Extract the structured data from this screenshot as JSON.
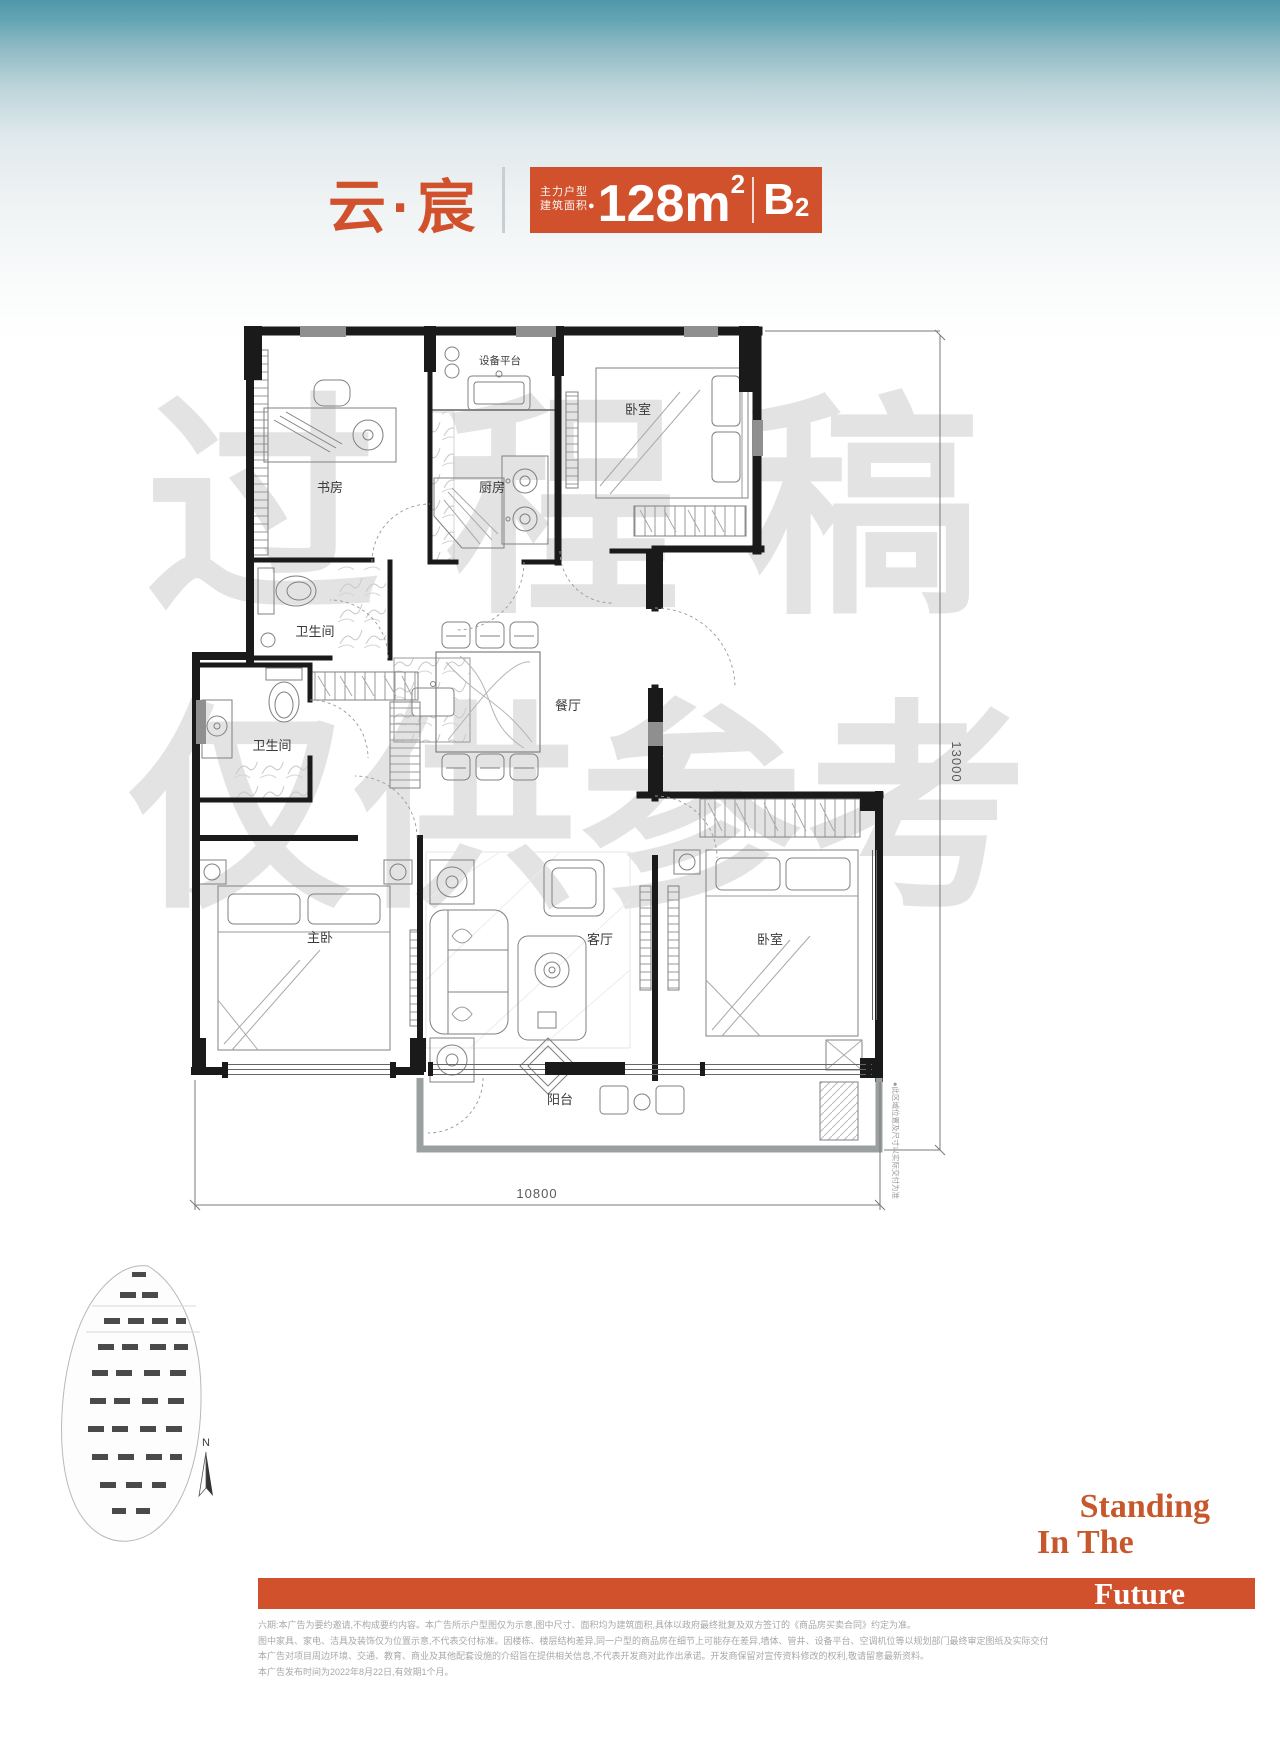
{
  "accent_color": "#d0512c",
  "header": {
    "title": "云·宸",
    "badge": {
      "type_line1": "主力户型",
      "type_line2": "建筑面积●",
      "area": "128m",
      "area_sup": "2",
      "unit": "B",
      "unit_sub": "2"
    }
  },
  "watermark": {
    "line1": "过程稿",
    "line2": "仅供参考"
  },
  "floor_plan": {
    "rooms": [
      {
        "label": "设备平台"
      },
      {
        "label": "书房"
      },
      {
        "label": "厨房"
      },
      {
        "label": "卧室"
      },
      {
        "label": "卫生间"
      },
      {
        "label": "卫生间"
      },
      {
        "label": "餐厅"
      },
      {
        "label": "主卧"
      },
      {
        "label": "客厅"
      },
      {
        "label": "卧室"
      },
      {
        "label": "阳台"
      }
    ],
    "dimensions": {
      "width": "10800",
      "height": "13000"
    },
    "side_note": "●此区域位置及尺寸以实际交付为准"
  },
  "compass": {
    "label": "N"
  },
  "slogan": {
    "line1": "Standing",
    "line2": "In The",
    "line3": "Future"
  },
  "disclaimer": {
    "lines": [
      "六期:本广告为要约邀请,不构成要约内容。本广告所示户型图仅为示意,图中尺寸、面积均为建筑面积,具体以政府最终批复及双方签订的《商品房买卖合同》约定为准。",
      "图中家具、家电、洁具及装饰仅为位置示意,不代表交付标准。因楼栋、楼层结构差异,同一户型的商品房在细节上可能存在差异,墙体、管井、设备平台、空调机位等以规划部门最终审定图纸及实际交付为准。",
      "本广告对项目周边环境、交通、教育、商业及其他配套设施的介绍旨在提供相关信息,不代表开发商对此作出承诺。开发商保留对宣传资料修改的权利,敬请留意最新资料。",
      "本广告发布时间为2022年8月22日,有效期1个月。"
    ]
  }
}
